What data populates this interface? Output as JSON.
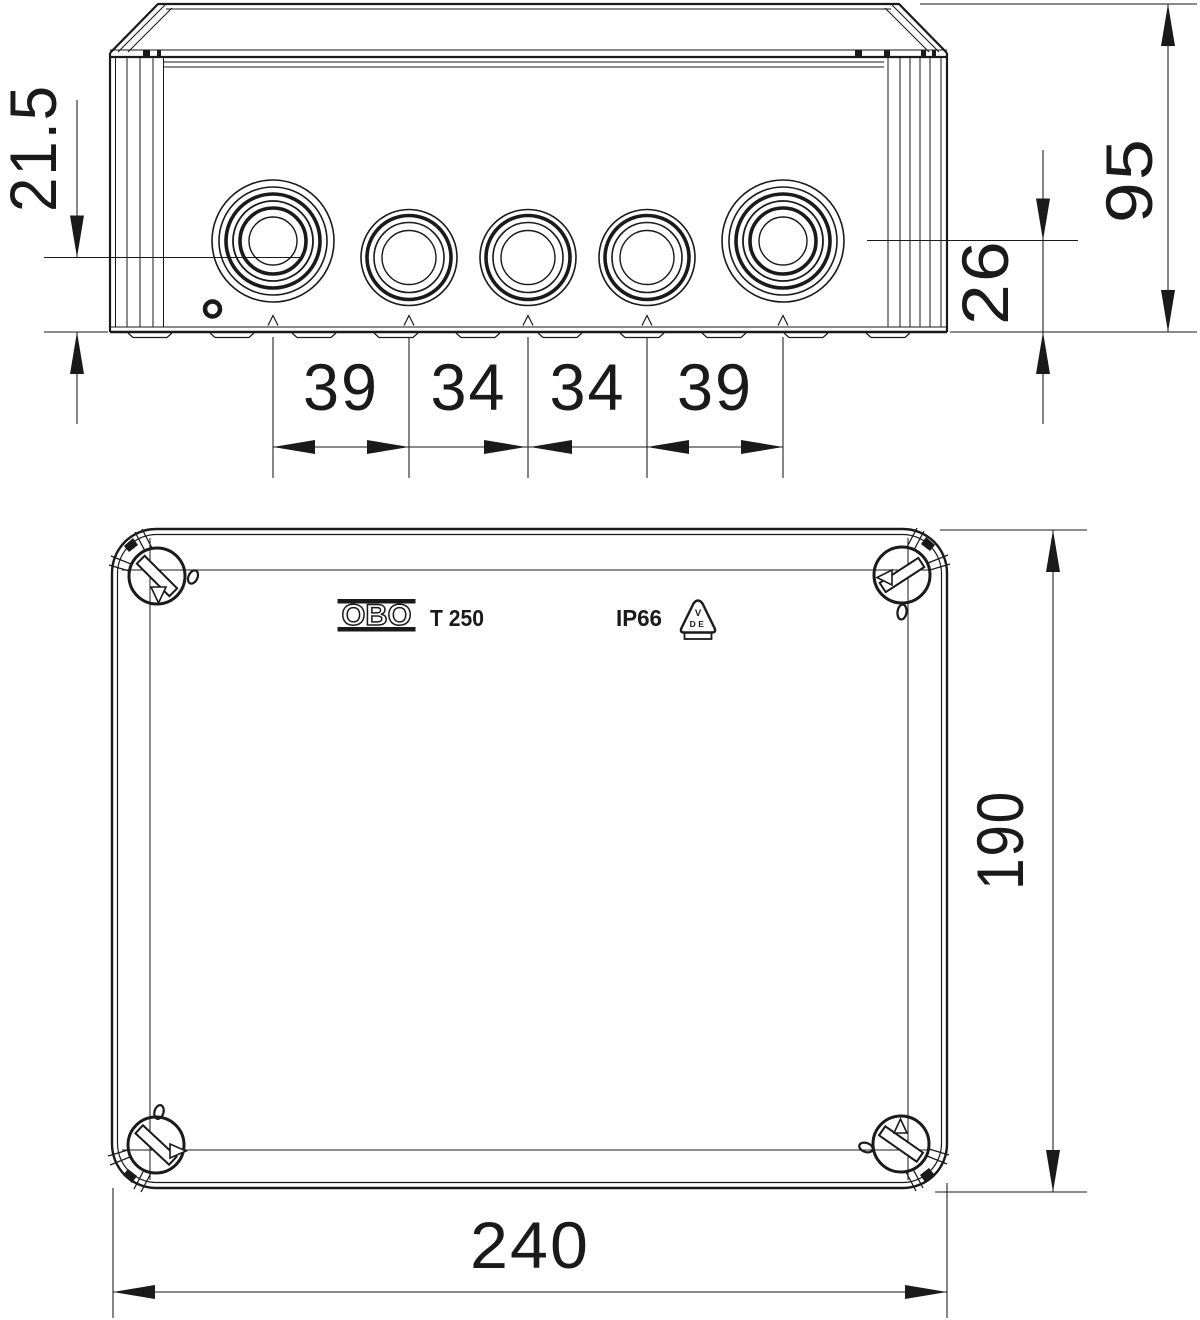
{
  "side_view": {
    "height": "95",
    "entry_center_large": "26",
    "entry_center_small": "21.5",
    "spacing_labels": [
      "39",
      "34",
      "34",
      "39"
    ]
  },
  "top_view": {
    "width": "240",
    "depth": "190"
  },
  "lid_markings": {
    "brand": "OBO",
    "model": "T 250",
    "ip_rating": "IP66",
    "vde_line1": "V",
    "vde_line2": "DE"
  }
}
